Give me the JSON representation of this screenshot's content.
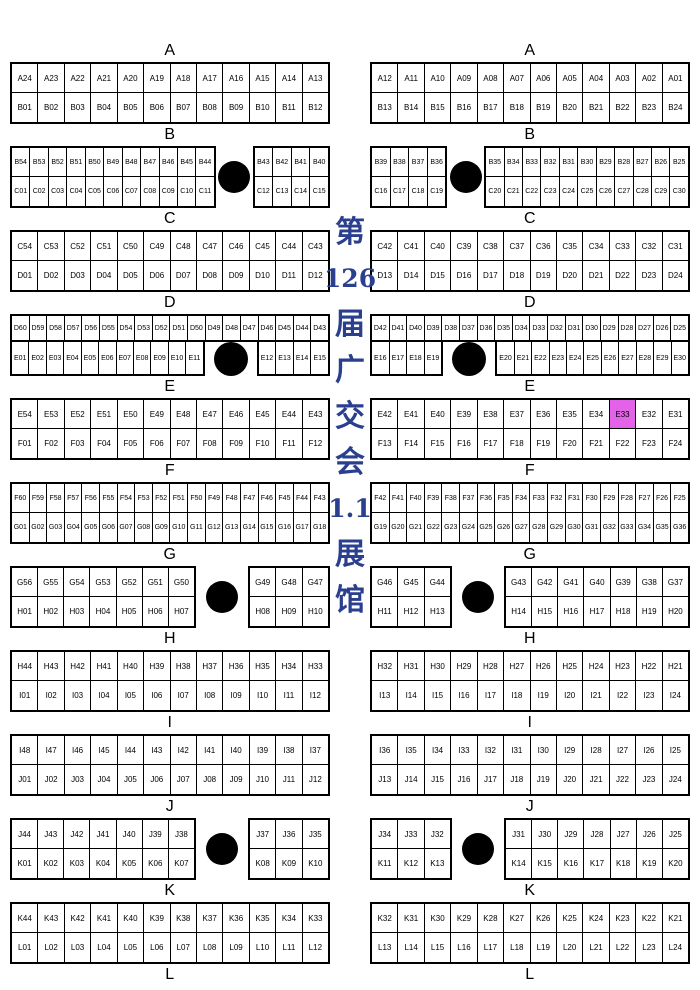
{
  "hall_title": {
    "full_text": "第126届广交会 1.1展馆",
    "lines": [
      "第",
      "126",
      "届",
      "广",
      "交",
      "会",
      "1.1",
      "展",
      "馆"
    ],
    "color": "#2b3f8f"
  },
  "highlight": {
    "booth": "E33",
    "color": "#e263e8"
  },
  "final_label": "L",
  "sections": [
    {
      "label": "A",
      "left": [
        {
          "type": "grid",
          "top": [
            "A24",
            "A23",
            "A22",
            "A21",
            "A20",
            "A19",
            "A18",
            "A17",
            "A16",
            "A15",
            "A14",
            "A13"
          ],
          "bottom": [
            "B01",
            "B02",
            "B03",
            "B04",
            "B05",
            "B06",
            "B07",
            "B08",
            "B09",
            "B10",
            "B11",
            "B12"
          ]
        }
      ],
      "right": [
        {
          "type": "grid",
          "top": [
            "A12",
            "A11",
            "A10",
            "A09",
            "A08",
            "A07",
            "A06",
            "A05",
            "A04",
            "A03",
            "A02",
            "A01"
          ],
          "bottom": [
            "B13",
            "B14",
            "B15",
            "B16",
            "B17",
            "B18",
            "B19",
            "B20",
            "B21",
            "B22",
            "B23",
            "B24"
          ]
        }
      ]
    },
    {
      "label": "B",
      "left": [
        {
          "type": "grid",
          "top": [
            "B54",
            "B53",
            "B52",
            "B51",
            "B50",
            "B49",
            "B48",
            "B47",
            "B46",
            "B45",
            "B44"
          ],
          "bottom": [
            "C01",
            "C02",
            "C03",
            "C04",
            "C05",
            "C06",
            "C07",
            "C08",
            "C09",
            "C10",
            "C11"
          ]
        },
        {
          "type": "gap",
          "units": 2
        },
        {
          "type": "grid",
          "top": [
            "B43",
            "B42",
            "B41",
            "B40"
          ],
          "bottom": [
            "C12",
            "C13",
            "C14",
            "C15"
          ]
        }
      ],
      "right": [
        {
          "type": "grid",
          "top": [
            "B39",
            "B38",
            "B37",
            "B36"
          ],
          "bottom": [
            "C16",
            "C17",
            "C18",
            "C19"
          ]
        },
        {
          "type": "gap",
          "units": 2
        },
        {
          "type": "grid",
          "top": [
            "B35",
            "B34",
            "B33",
            "B32",
            "B31",
            "B30",
            "B29",
            "B28",
            "B27",
            "B26",
            "B25"
          ],
          "bottom": [
            "C20",
            "C21",
            "C22",
            "C23",
            "C24",
            "C25",
            "C26",
            "C27",
            "C28",
            "C29",
            "C30"
          ]
        }
      ]
    },
    {
      "label": "C",
      "left": [
        {
          "type": "grid",
          "top": [
            "C54",
            "C53",
            "C52",
            "C51",
            "C50",
            "C49",
            "C48",
            "C47",
            "C46",
            "C45",
            "C44",
            "C43"
          ],
          "bottom": [
            "D01",
            "D02",
            "D03",
            "D04",
            "D05",
            "D06",
            "D07",
            "D08",
            "D09",
            "D10",
            "D11",
            "D12"
          ]
        }
      ],
      "right": [
        {
          "type": "grid",
          "top": [
            "C42",
            "C41",
            "C40",
            "C39",
            "C38",
            "C37",
            "C36",
            "C35",
            "C34",
            "C33",
            "C32",
            "C31"
          ],
          "bottom": [
            "D13",
            "D14",
            "D15",
            "D16",
            "D17",
            "D18",
            "D19",
            "D20",
            "D21",
            "D22",
            "D23",
            "D24"
          ]
        }
      ]
    },
    {
      "label": "D",
      "left": [
        {
          "type": "dgrid",
          "top": [
            "D60",
            "D59",
            "D58",
            "D57",
            "D56",
            "D55",
            "D54",
            "D53",
            "D52",
            "D51",
            "D50",
            "D49",
            "D48",
            "D47",
            "D46",
            "D45",
            "D44",
            "D43"
          ],
          "bottom_left": [
            "E01",
            "E02",
            "E03",
            "E04",
            "E05",
            "E06",
            "E07",
            "E08",
            "E09",
            "E10",
            "E11"
          ],
          "gap_units": 3,
          "bottom_right": [
            "E12",
            "E13",
            "E14",
            "E15"
          ]
        }
      ],
      "right": [
        {
          "type": "dgrid",
          "top": [
            "D42",
            "D41",
            "D40",
            "D39",
            "D38",
            "D37",
            "D36",
            "D35",
            "D34",
            "D33",
            "D32",
            "D31",
            "D30",
            "D29",
            "D28",
            "D27",
            "D26",
            "D25"
          ],
          "bottom_left": [
            "E16",
            "E17",
            "E18",
            "E19"
          ],
          "gap_units": 3,
          "bottom_right": [
            "E20",
            "E21",
            "E22",
            "E23",
            "E24",
            "E25",
            "E26",
            "E27",
            "E28",
            "E29",
            "E30"
          ]
        }
      ]
    },
    {
      "label": "E",
      "left": [
        {
          "type": "grid",
          "top": [
            "E54",
            "E53",
            "E52",
            "E51",
            "E50",
            "E49",
            "E48",
            "E47",
            "E46",
            "E45",
            "E44",
            "E43"
          ],
          "bottom": [
            "F01",
            "F02",
            "F03",
            "F04",
            "F05",
            "F06",
            "F07",
            "F08",
            "F09",
            "F10",
            "F11",
            "F12"
          ]
        }
      ],
      "right": [
        {
          "type": "grid",
          "top": [
            "E42",
            "E41",
            "E40",
            "E39",
            "E38",
            "E37",
            "E36",
            "E35",
            "E34",
            "E33",
            "E32",
            "E31"
          ],
          "bottom": [
            "F13",
            "F14",
            "F15",
            "F16",
            "F17",
            "F18",
            "F19",
            "F20",
            "F21",
            "F22",
            "F23",
            "F24"
          ]
        }
      ]
    },
    {
      "label": "F",
      "left": [
        {
          "type": "grid",
          "top": [
            "F60",
            "F59",
            "F58",
            "F57",
            "F56",
            "F55",
            "F54",
            "F53",
            "F52",
            "F51",
            "F50",
            "F49",
            "F48",
            "F47",
            "F46",
            "F45",
            "F44",
            "F43"
          ],
          "bottom": [
            "G01",
            "G02",
            "G03",
            "G04",
            "G05",
            "G06",
            "G07",
            "G08",
            "G09",
            "G10",
            "G11",
            "G12",
            "G13",
            "G14",
            "G15",
            "G16",
            "G17",
            "G18"
          ]
        }
      ],
      "right": [
        {
          "type": "grid",
          "top": [
            "F42",
            "F41",
            "F40",
            "F39",
            "F38",
            "F37",
            "F36",
            "F35",
            "F34",
            "F33",
            "F32",
            "F31",
            "F30",
            "F29",
            "F28",
            "F27",
            "F26",
            "F25"
          ],
          "bottom": [
            "G19",
            "G20",
            "G21",
            "G22",
            "G23",
            "G24",
            "G25",
            "G26",
            "G27",
            "G28",
            "G29",
            "G30",
            "G31",
            "G32",
            "G33",
            "G34",
            "G35",
            "G36"
          ]
        }
      ]
    },
    {
      "label": "G",
      "left": [
        {
          "type": "grid",
          "top": [
            "G56",
            "G55",
            "G54",
            "G53",
            "G52",
            "G51",
            "G50"
          ],
          "bottom": [
            "H01",
            "H02",
            "H03",
            "H04",
            "H05",
            "H06",
            "H07"
          ]
        },
        {
          "type": "gap",
          "units": 2
        },
        {
          "type": "grid",
          "top": [
            "G49",
            "G48",
            "G47"
          ],
          "bottom": [
            "H08",
            "H09",
            "H10"
          ]
        }
      ],
      "right": [
        {
          "type": "grid",
          "top": [
            "G46",
            "G45",
            "G44"
          ],
          "bottom": [
            "H11",
            "H12",
            "H13"
          ]
        },
        {
          "type": "gap",
          "units": 2
        },
        {
          "type": "grid",
          "top": [
            "G43",
            "G42",
            "G41",
            "G40",
            "G39",
            "G38",
            "G37"
          ],
          "bottom": [
            "H14",
            "H15",
            "H16",
            "H17",
            "H18",
            "H19",
            "H20"
          ]
        }
      ]
    },
    {
      "label": "H",
      "left": [
        {
          "type": "grid",
          "top": [
            "H44",
            "H43",
            "H42",
            "H41",
            "H40",
            "H39",
            "H38",
            "H37",
            "H36",
            "H35",
            "H34",
            "H33"
          ],
          "bottom": [
            "I01",
            "I02",
            "I03",
            "I04",
            "I05",
            "I06",
            "I07",
            "I08",
            "I09",
            "I10",
            "I11",
            "I12"
          ]
        }
      ],
      "right": [
        {
          "type": "grid",
          "top": [
            "H32",
            "H31",
            "H30",
            "H29",
            "H28",
            "H27",
            "H26",
            "H25",
            "H24",
            "H23",
            "H22",
            "H21"
          ],
          "bottom": [
            "I13",
            "I14",
            "I15",
            "I16",
            "I17",
            "I18",
            "I19",
            "I20",
            "I21",
            "I22",
            "I23",
            "I24"
          ]
        }
      ]
    },
    {
      "label": "I",
      "left": [
        {
          "type": "grid",
          "top": [
            "I48",
            "I47",
            "I46",
            "I45",
            "I44",
            "I43",
            "I42",
            "I41",
            "I40",
            "I39",
            "I38",
            "I37"
          ],
          "bottom": [
            "J01",
            "J02",
            "J03",
            "J04",
            "J05",
            "J06",
            "J07",
            "J08",
            "J09",
            "J10",
            "J11",
            "J12"
          ]
        }
      ],
      "right": [
        {
          "type": "grid",
          "top": [
            "I36",
            "I35",
            "I34",
            "I33",
            "I32",
            "I31",
            "I30",
            "I29",
            "I28",
            "I27",
            "I26",
            "I25"
          ],
          "bottom": [
            "J13",
            "J14",
            "J15",
            "J16",
            "J17",
            "J18",
            "J19",
            "J20",
            "J21",
            "J22",
            "J23",
            "J24"
          ]
        }
      ]
    },
    {
      "label": "J",
      "left": [
        {
          "type": "grid",
          "top": [
            "J44",
            "J43",
            "J42",
            "J41",
            "J40",
            "J39",
            "J38"
          ],
          "bottom": [
            "K01",
            "K02",
            "K03",
            "K04",
            "K05",
            "K06",
            "K07"
          ]
        },
        {
          "type": "gap",
          "units": 2
        },
        {
          "type": "grid",
          "top": [
            "J37",
            "J36",
            "J35"
          ],
          "bottom": [
            "K08",
            "K09",
            "K10"
          ]
        }
      ],
      "right": [
        {
          "type": "grid",
          "top": [
            "J34",
            "J33",
            "J32"
          ],
          "bottom": [
            "K11",
            "K12",
            "K13"
          ]
        },
        {
          "type": "gap",
          "units": 2
        },
        {
          "type": "grid",
          "top": [
            "J31",
            "J30",
            "J29",
            "J28",
            "J27",
            "J26",
            "J25"
          ],
          "bottom": [
            "K14",
            "K15",
            "K16",
            "K17",
            "K18",
            "K19",
            "K20"
          ]
        }
      ]
    },
    {
      "label": "K",
      "left": [
        {
          "type": "grid",
          "top": [
            "K44",
            "K43",
            "K42",
            "K41",
            "K40",
            "K39",
            "K38",
            "K37",
            "K36",
            "K35",
            "K34",
            "K33"
          ],
          "bottom": [
            "L01",
            "L02",
            "L03",
            "L04",
            "L05",
            "L06",
            "L07",
            "L08",
            "L09",
            "L10",
            "L11",
            "L12"
          ]
        }
      ],
      "right": [
        {
          "type": "grid",
          "top": [
            "K32",
            "K31",
            "K30",
            "K29",
            "K28",
            "K27",
            "K26",
            "K25",
            "K24",
            "K23",
            "K22",
            "K21"
          ],
          "bottom": [
            "L13",
            "L14",
            "L15",
            "L16",
            "L17",
            "L18",
            "L19",
            "L20",
            "L21",
            "L22",
            "L23",
            "L24"
          ]
        }
      ]
    }
  ]
}
